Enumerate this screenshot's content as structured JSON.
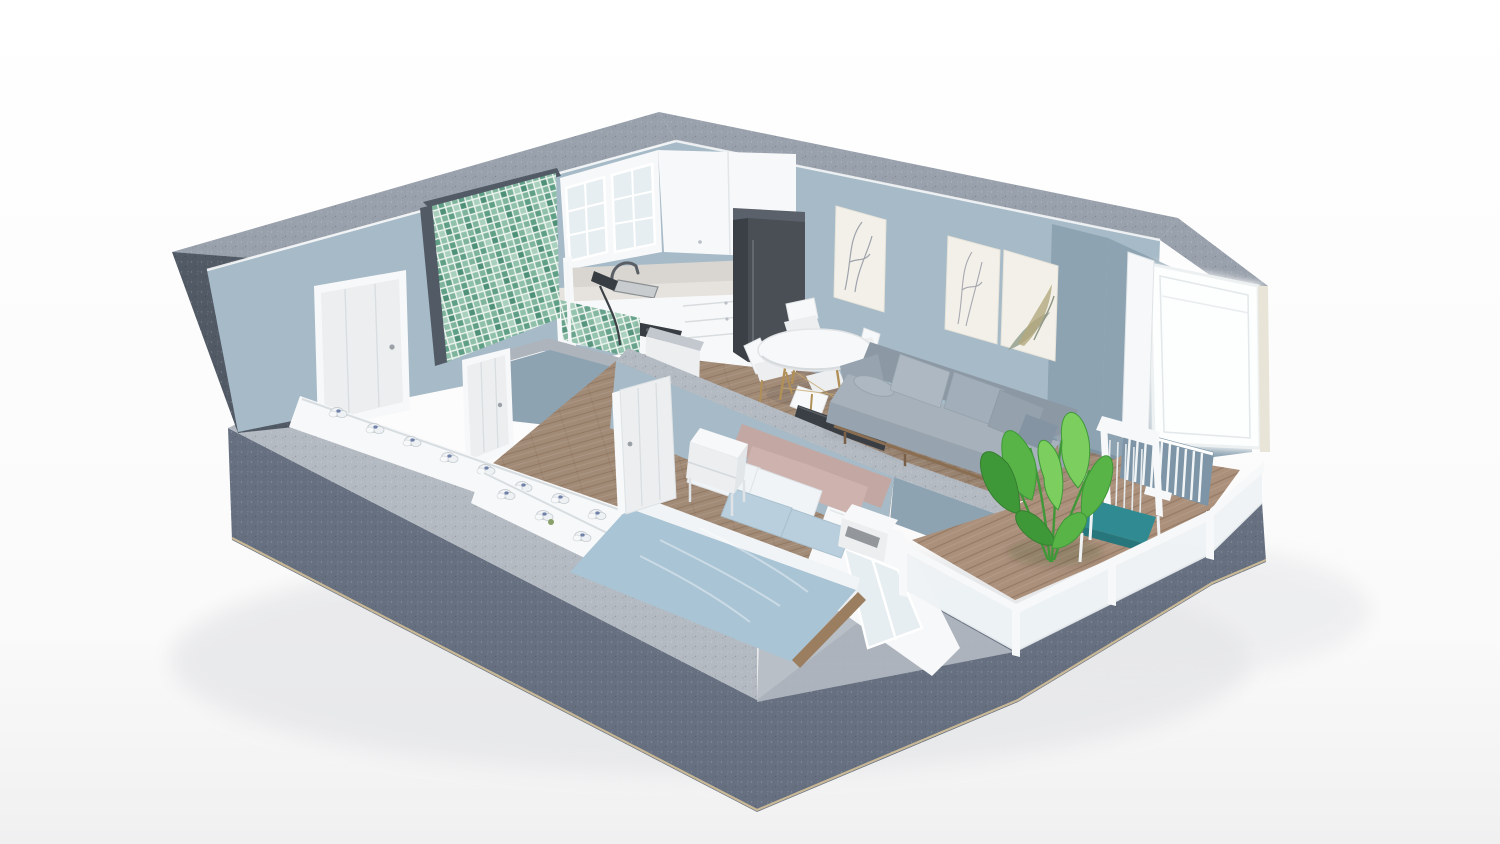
{
  "app": {
    "type": "3d-floorplan-render",
    "view": "isometric-cutaway-apartment",
    "background": "#ffffff"
  },
  "colors": {
    "bg_top": "#ffffff",
    "bg_bottom": "#f1f1f2",
    "ground_shadow": "#e0e1e3",
    "concrete_dark": "#525a66",
    "concrete_mid": "#667080",
    "concrete_light": "#76808d",
    "concrete_band": "#99a1ac",
    "concrete_topL": "#b4bac2",
    "edge_tan": "#d9c49a",
    "wall_blue": "#a6bac7",
    "wall_blue_dark": "#8da3b2",
    "wall_blue_deep": "#7d95a6",
    "wall_blue_light": "#b7c8d2",
    "floor_wood": "#a18a76",
    "floor_wood_dark": "#8f7a67",
    "deck_wood": "#ab907b",
    "white": "#f7f8f9",
    "off_white": "#eceef0",
    "shadow_white": "#dde1e4",
    "glass": "#e7eef1",
    "marble": "#d9d6d1",
    "marble_light": "#e6e3de",
    "fridge_dark": "#4a4f56",
    "fridge_side": "#3b4046",
    "fridge_top": "#5b616a",
    "steel": "#9aa0a6",
    "dark_metal": "#383d43",
    "sofa_body": "#97a3ae",
    "sofa_body_light": "#a6b1bb",
    "sofa_body_dark": "#8c98a4",
    "cushion_light": "#adb8c2",
    "cushion_mid": "#a2aeba",
    "cushion_dark": "#95a2ae",
    "cushion_deep": "#8494a2",
    "wood_frame": "#8a6e52",
    "leg_tan": "#b19057",
    "duvet_blue": "#a9c4d5",
    "pillow_blue": "#b9cfdd",
    "pillow_white": "#f1f4f6",
    "headboard_pink": "#c3a7a3",
    "pillow_pink": "#cdb2ae",
    "tile_a": "#7fb49c",
    "tile_b": "#5f9f86",
    "tile_c": "#a9cfbd",
    "tile_d": "#4f9078",
    "tile_e": "#8fc0aa",
    "tile_grout": "#eef5f0",
    "plant_green": "#58b447",
    "plant_green_dark": "#3f9838",
    "plant_green_light": "#7ccf5e",
    "teal_cushion": "#2f8b91",
    "teal_cushion_dark": "#27767c",
    "tv_dark": "#3a3f45",
    "art_bg": "#f2f0e9",
    "art_green": "#95a08c",
    "art_gray": "#9fa3ab",
    "art_olive": "#b3a97e",
    "radiator_blue": "#5c709d",
    "door_glow": "#fdfefe"
  },
  "scene": {
    "style": "cutaway walls, concrete shell, blue-gray interior paint, wood floors",
    "rooms": [
      {
        "name": "hallway",
        "objects": [
          "entrance-door",
          "window-trough-radiators"
        ]
      },
      {
        "name": "bathroom",
        "objects": [
          "green-mosaic-tile-wall",
          "bathtub",
          "shower-set",
          "bathroom-door"
        ]
      },
      {
        "name": "kitchen",
        "objects": [
          "glass-upper-cabinets",
          "upper-cabinets",
          "marble-counter",
          "sink",
          "faucet",
          "cooktop",
          "tall-fridge-cabinet",
          "base-drawers",
          "half-wall"
        ]
      },
      {
        "name": "dining",
        "objects": [
          "round-white-table",
          "eames-chair",
          "eames-chair",
          "eames-chair",
          "eames-chair"
        ]
      },
      {
        "name": "living",
        "objects": [
          "gray-sofa",
          "bolster-pillow",
          "back-cushions",
          "wall-art-single",
          "wall-art-pair",
          "tv-low-panel"
        ]
      },
      {
        "name": "bedroom",
        "objects": [
          "double-bed",
          "blue-duvet",
          "white-pillows",
          "blue-pillows",
          "pink-headboard",
          "nightstand-left",
          "nightstand-right",
          "bedroom-door",
          "window-bay",
          "window-trough-radiators"
        ]
      },
      {
        "name": "balcony",
        "objects": [
          "wood-deck",
          "glass-railing",
          "white-armchair-teal-cushion",
          "banana-plant",
          "wall-radiator",
          "glass-door-open"
        ]
      }
    ],
    "counts": {
      "dining_chairs": 4,
      "art_panels": 3,
      "bed_pillows": 6,
      "radiator_sections_hall": 8,
      "radiator_sections_bedroom": 5
    }
  }
}
